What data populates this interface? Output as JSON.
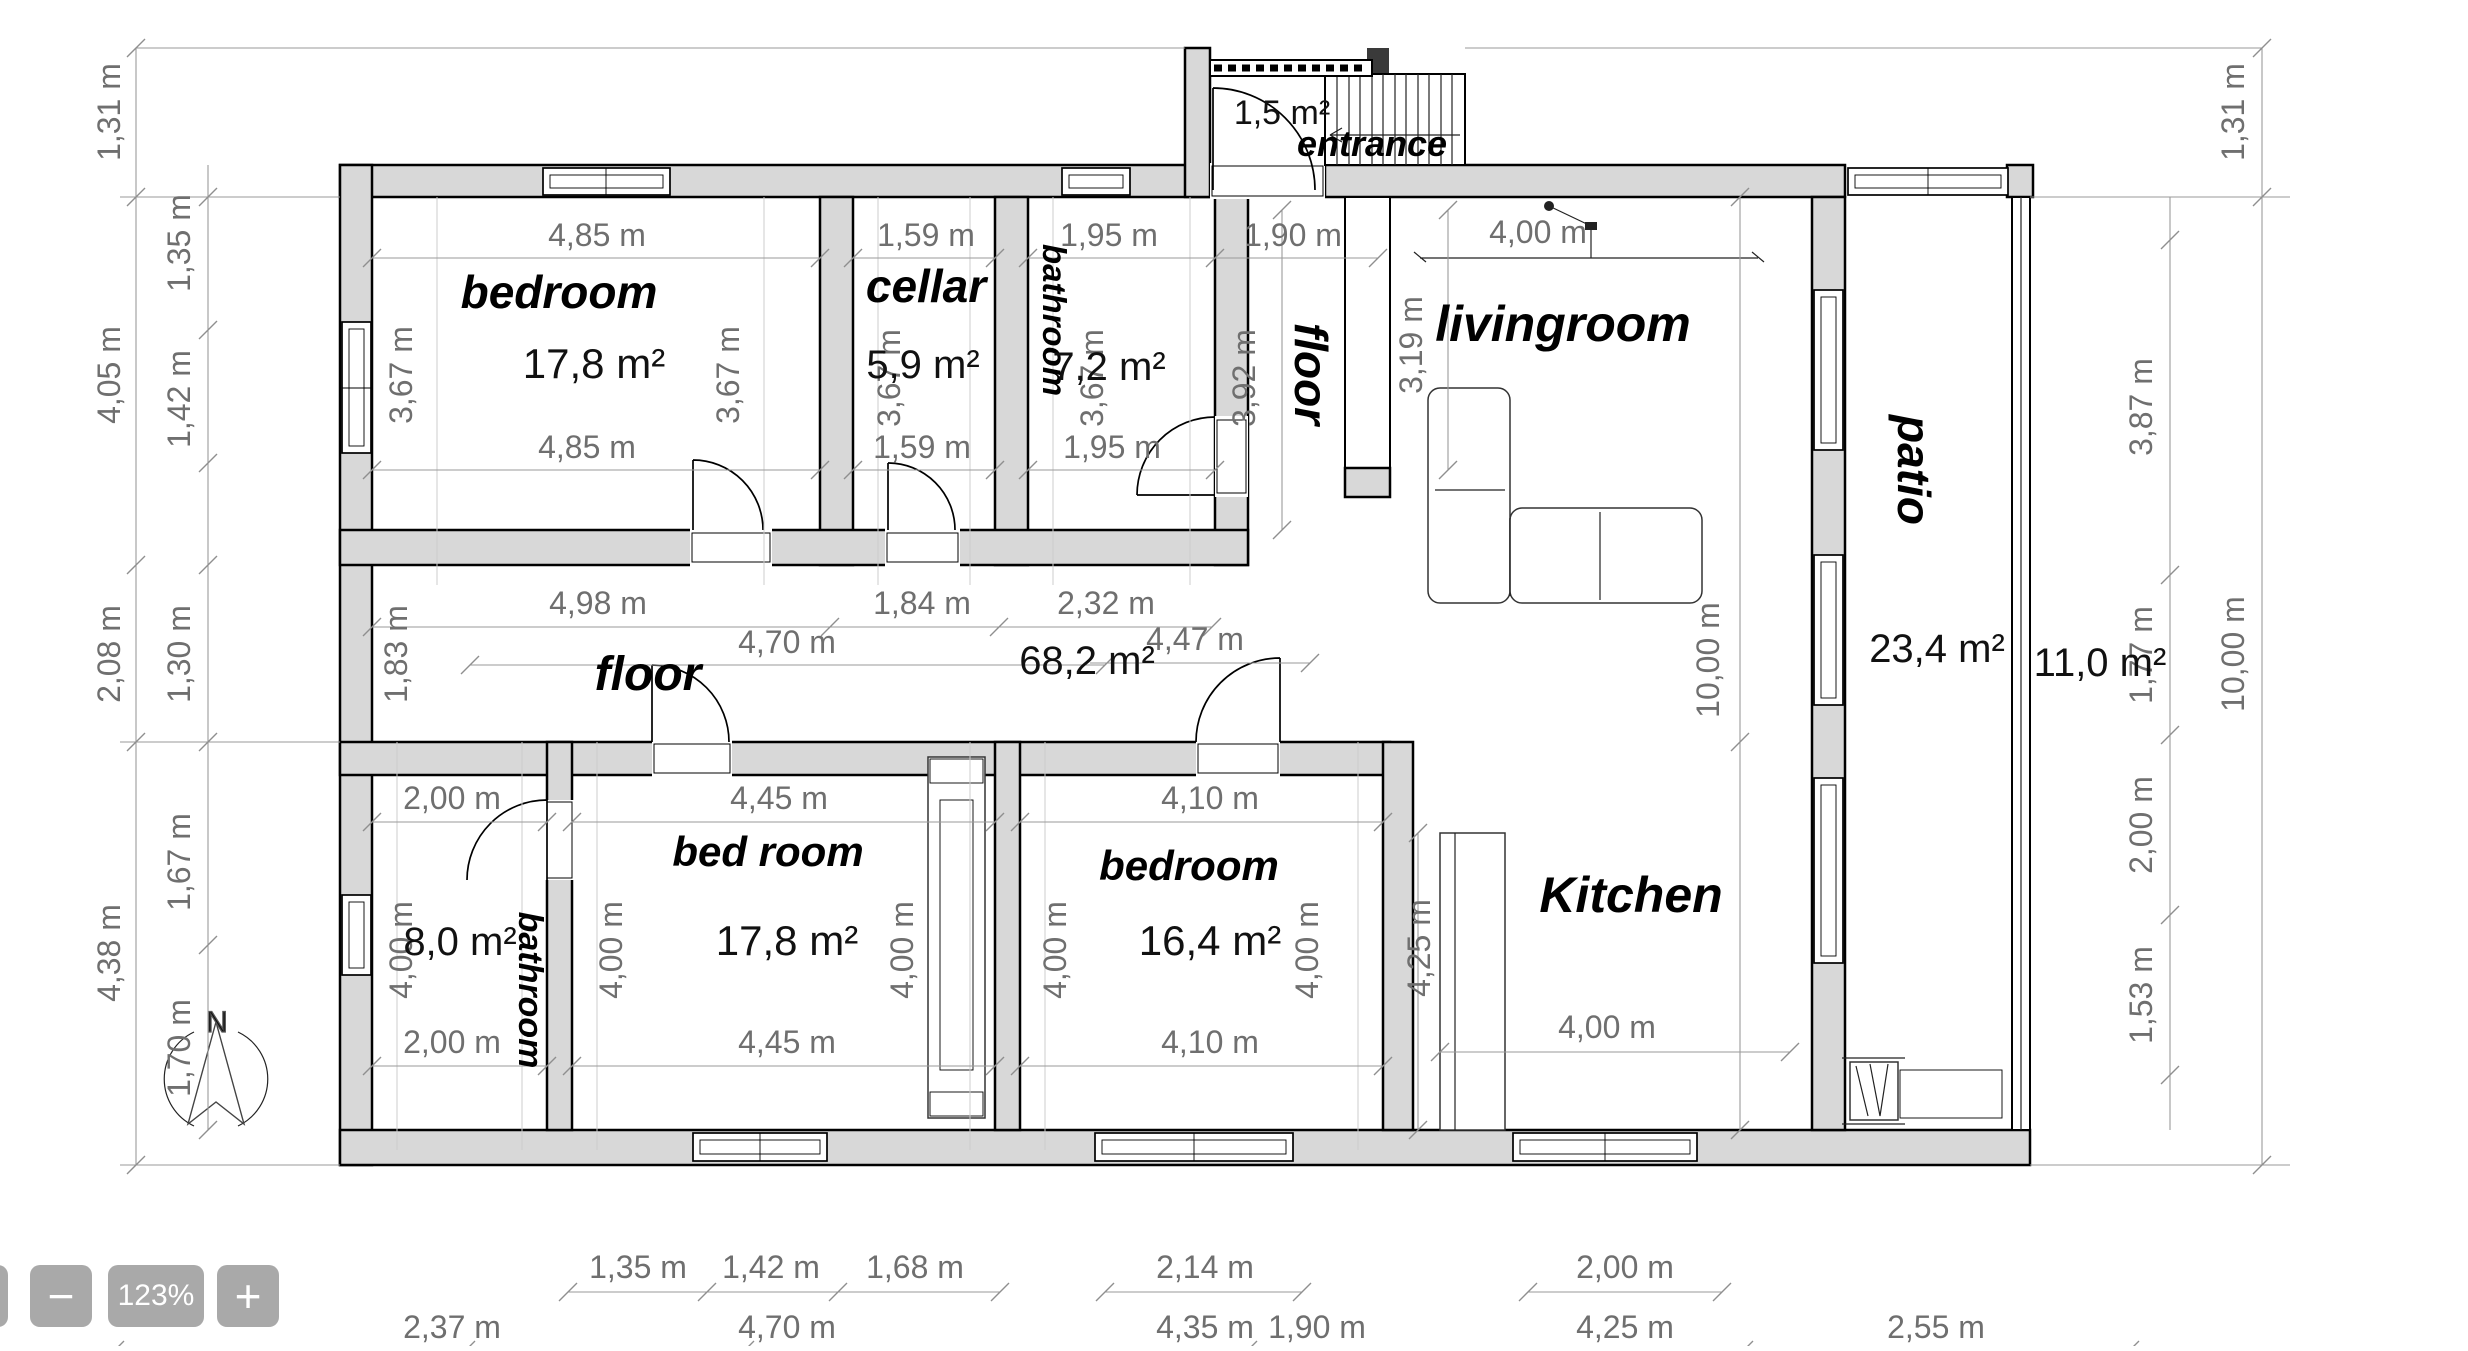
{
  "toolbar": {
    "zoom_out": "−",
    "zoom_level": "123%",
    "zoom_in": "+"
  },
  "compass": {
    "north": "N"
  },
  "rooms": {
    "entrance": {
      "label": "entrance",
      "area": "1,5 m²"
    },
    "bedroom_nw": {
      "label": "bedroom",
      "area": "17,8 m²",
      "top": "4,85 m",
      "bottom": "4,85 m",
      "left": "3,67 m",
      "right": "3,67 m"
    },
    "cellar": {
      "label": "cellar",
      "area": "5,9 m²",
      "top": "1,59 m",
      "bottom": "1,59 m",
      "side": "3,67 m"
    },
    "bathroom_n": {
      "label": "bathroom",
      "area": "7,2 m²",
      "top": "1,95 m",
      "bottom": "1,95 m",
      "side": "3,67 m"
    },
    "hall_n": {
      "label": "floor",
      "width": "1,90 m",
      "depth": "3,92 m"
    },
    "livingroom": {
      "label": "livingroom",
      "width": "4,00 m",
      "height": "3,19 m",
      "depth": "10,00 m"
    },
    "patio": {
      "label": "patio",
      "area": "23,4 m²",
      "side_area": "11,0 m²"
    },
    "floor_hall": {
      "label": "floor",
      "area": "68,2 m²",
      "top_segments": [
        "4,98 m",
        "1,84 m",
        "2,32 m"
      ],
      "mid_segments": [
        "4,70 m",
        "4,47 m"
      ],
      "left": "1,83 m"
    },
    "bathroom_sw": {
      "label": "bathroom",
      "area": "8,0 m²",
      "top": "2,00 m",
      "bottom": "2,00 m",
      "left": "4,00 m"
    },
    "bedroom_s": {
      "label": "bed room",
      "area": "17,8 m²",
      "top": "4,45 m",
      "bottom": "4,45 m",
      "left": "4,00 m",
      "right": "4,00 m"
    },
    "bedroom_se": {
      "label": "bedroom",
      "area": "16,4 m²",
      "top": "4,10 m",
      "bottom": "4,10 m",
      "left": "4,00 m",
      "right": "4,00 m"
    },
    "kitchen": {
      "label": "Kitchen",
      "left": "4,25 m",
      "bottom": "4,00 m"
    }
  },
  "dimensions": {
    "left_outer": [
      "1,31 m",
      "4,05 m",
      "2,08 m",
      "4,38 m"
    ],
    "left_inner": [
      "1,35 m",
      "1,42 m",
      "1,30 m",
      "1,67 m",
      "1,70 m"
    ],
    "right_inner": [
      "3,87 m",
      "1,77 m",
      "2,00 m",
      "1,53 m"
    ],
    "right_outer": [
      "1,31 m",
      "10,00 m"
    ],
    "bottom_upper": [
      "1,35 m",
      "1,42 m",
      "1,68 m",
      "2,14 m",
      "2,00 m"
    ],
    "bottom_lower": [
      "2,37 m",
      "4,70 m",
      "4,35 m",
      "1,90 m",
      "4,25 m",
      "2,55 m"
    ]
  }
}
